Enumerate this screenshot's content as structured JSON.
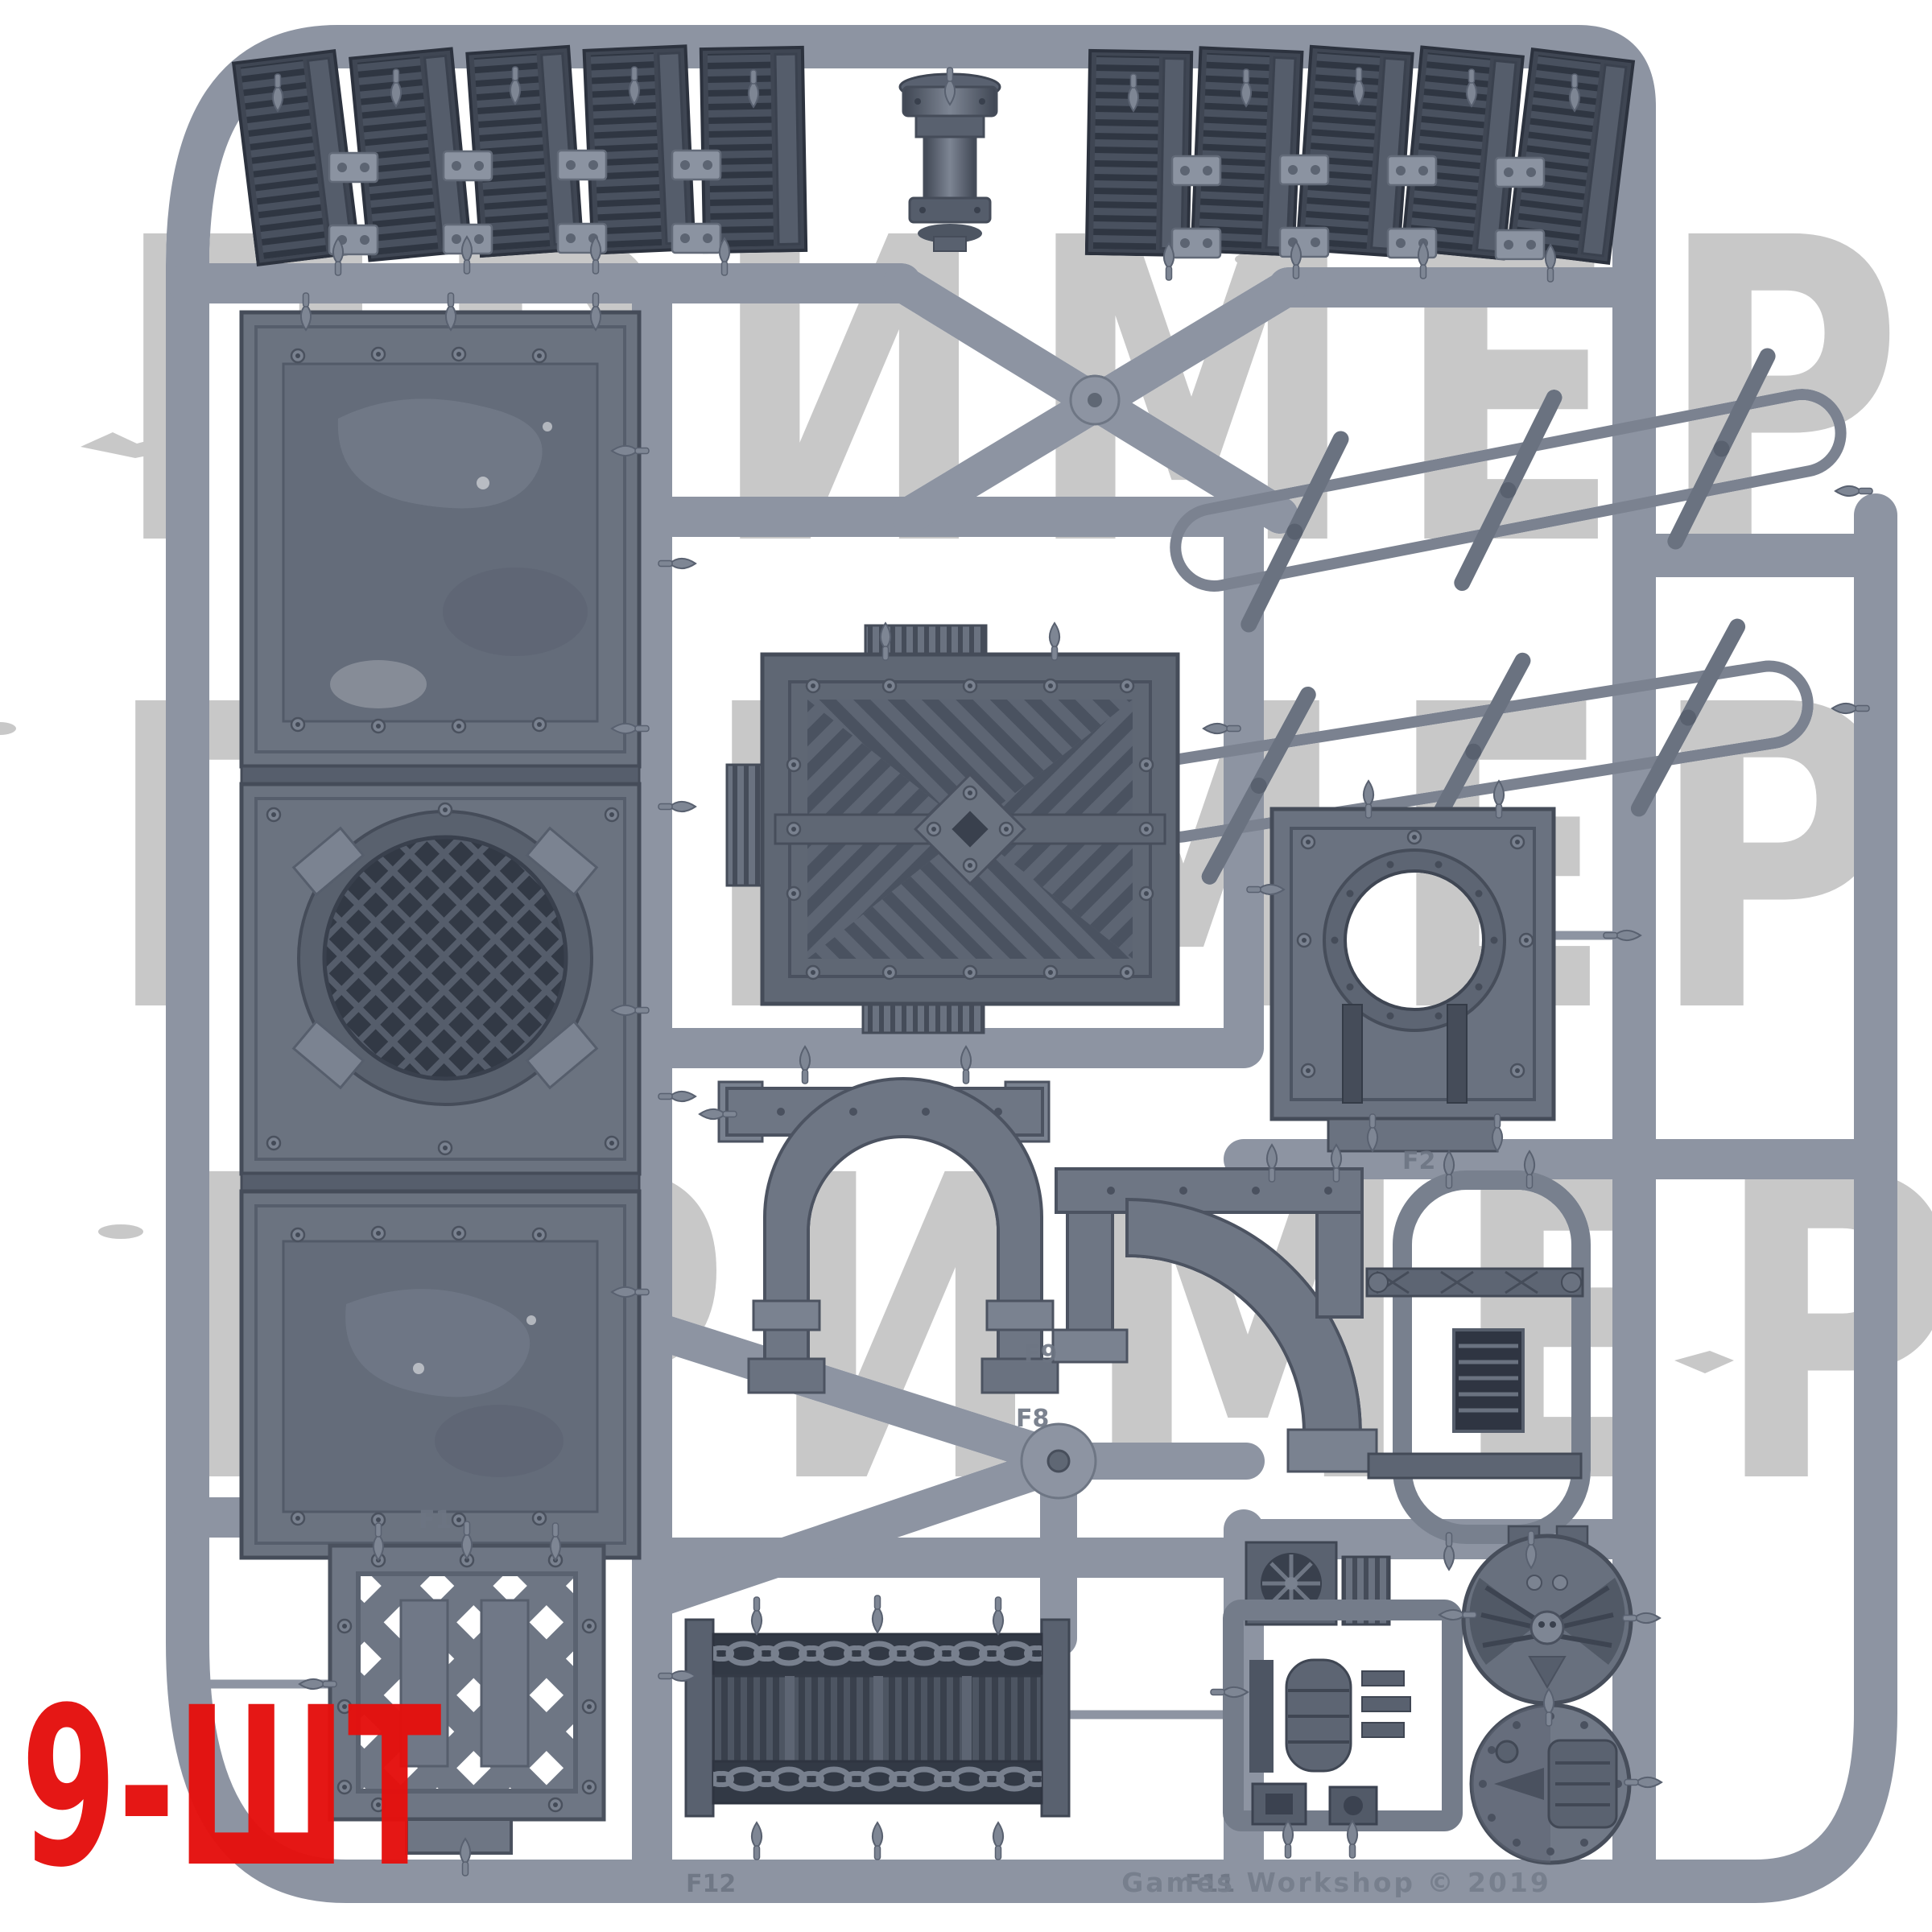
{
  "photo": {
    "subject": "grey plastic model sprue with industrial terrain parts",
    "background_color": "#ffffff",
    "plastic_frame_color": "#8d94a2",
    "part_color_mid": "#6a7280",
    "part_color_dark": "#3f4653"
  },
  "watermark": {
    "text": "ПРИМЕР",
    "color": "#c8c8c8",
    "rows": [
      {
        "text": "ПРИМЕР"
      },
      {
        "text": "ПРИМЕР"
      },
      {
        "text": "ПРИМЕР"
      }
    ]
  },
  "quantity_label": {
    "text": "9-ШТ",
    "color": "#e5100e"
  },
  "sprue": {
    "embossed_text": "Games Workshop © 2019",
    "part_labels": [
      "F1",
      "F2",
      "F8",
      "F9",
      "F11",
      "F12"
    ]
  }
}
